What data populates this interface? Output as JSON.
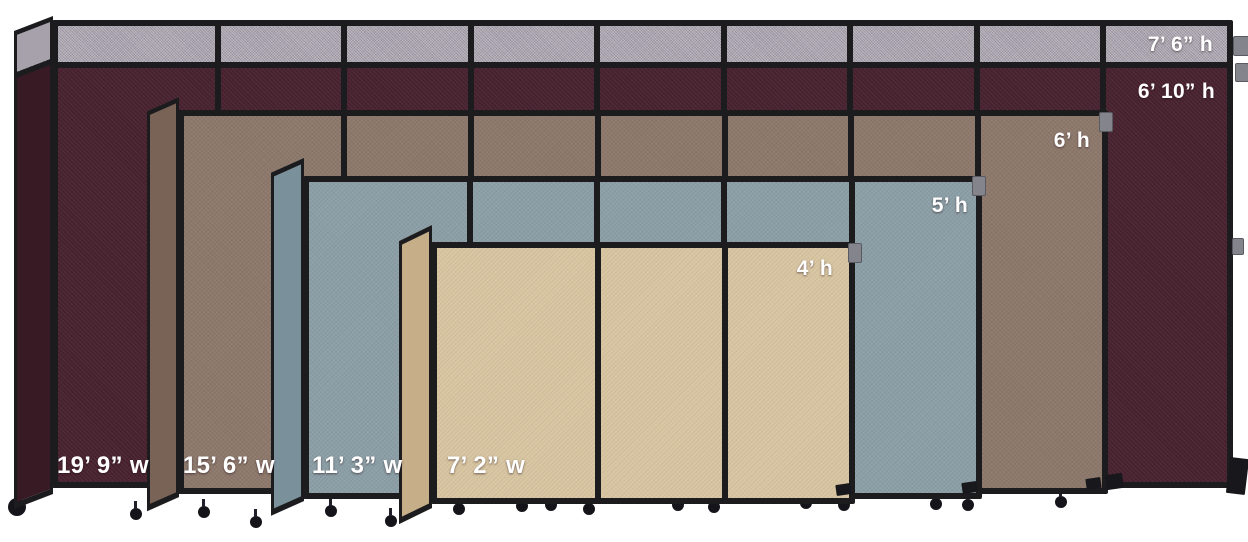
{
  "title": "Portable partition size comparison",
  "colors": {
    "background": "#ffffff",
    "frame": "#1c1c1f",
    "topper_gray": "#a7a1ab",
    "burgundy": "#48222f",
    "burgundy_end": "#381a25",
    "brown": "#8d786b",
    "brown_end": "#796357",
    "slate": "#8c9fa6",
    "slate_end": "#7a909b",
    "beige": "#d8c5a1",
    "beige_end": "#c5ae88",
    "label_text": "#ffffff"
  },
  "partitions": [
    {
      "fabric": "burgundy wine",
      "fabric_hex": "#48222f",
      "topper_height_label": "7’ 6” h",
      "height_label": "6’ 10” h",
      "width_label": "19’ 9” w",
      "visible_front_panels": 9,
      "has_gray_topper": true
    },
    {
      "fabric": "brown taupe",
      "fabric_hex": "#8d786b",
      "height_label": "6’ h",
      "width_label": "15’ 6” w",
      "visible_front_panels": 7,
      "has_gray_topper": false
    },
    {
      "fabric": "slate blue-gray",
      "fabric_hex": "#8c9fa6",
      "height_label": "5’ h",
      "width_label": "11’ 3” w",
      "visible_front_panels": 5,
      "has_gray_topper": false
    },
    {
      "fabric": "beige tan",
      "fabric_hex": "#d8c5a1",
      "height_label": "4’ h",
      "width_label": "7’ 2” w",
      "visible_front_panels": 3,
      "has_gray_topper": false
    }
  ]
}
